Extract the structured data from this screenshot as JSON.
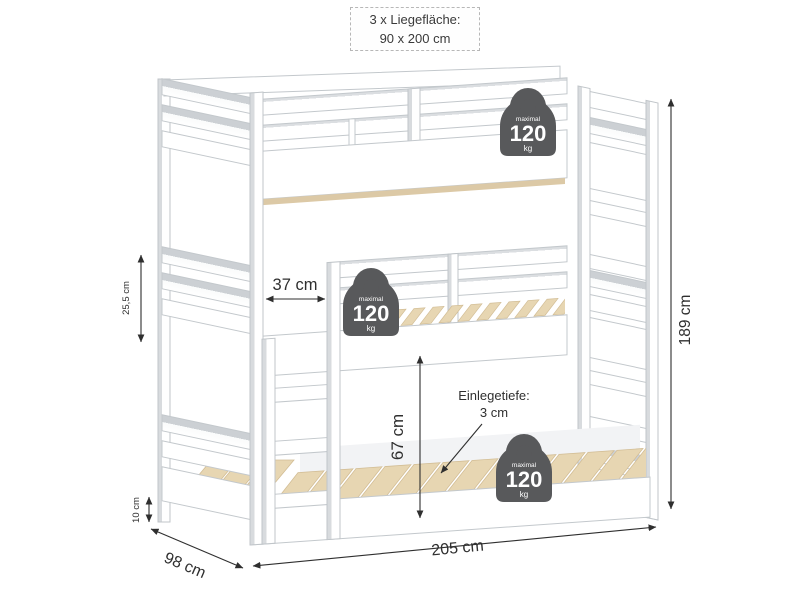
{
  "header_box": {
    "line1": "3 x Liegefläche:",
    "line2": "90 x 200 cm"
  },
  "weight_badges": [
    {
      "label": "maximal",
      "value": "120",
      "unit": "kg"
    },
    {
      "label": "maximal",
      "value": "120",
      "unit": "kg"
    },
    {
      "label": "maximal",
      "value": "120",
      "unit": "kg"
    }
  ],
  "dimensions": {
    "entry_gap": "37 cm",
    "under_bunk_height": "67 cm",
    "insert_depth_label": "Einlegetiefe:",
    "insert_depth_value": "3 cm",
    "guard_rail_height": "25,5 cm",
    "floor_clearance": "10 cm",
    "bed_depth": "98 cm",
    "bed_length": "205 cm",
    "bed_height": "189 cm"
  },
  "colors": {
    "frame_white": "#ffffff",
    "outline_gray": "#c3c8cc",
    "shade_gray": "#ccd0d4",
    "slat_wood": "#e7d6b2",
    "badge_gray": "#58595b",
    "dimension_ink": "#2f2f2f"
  }
}
